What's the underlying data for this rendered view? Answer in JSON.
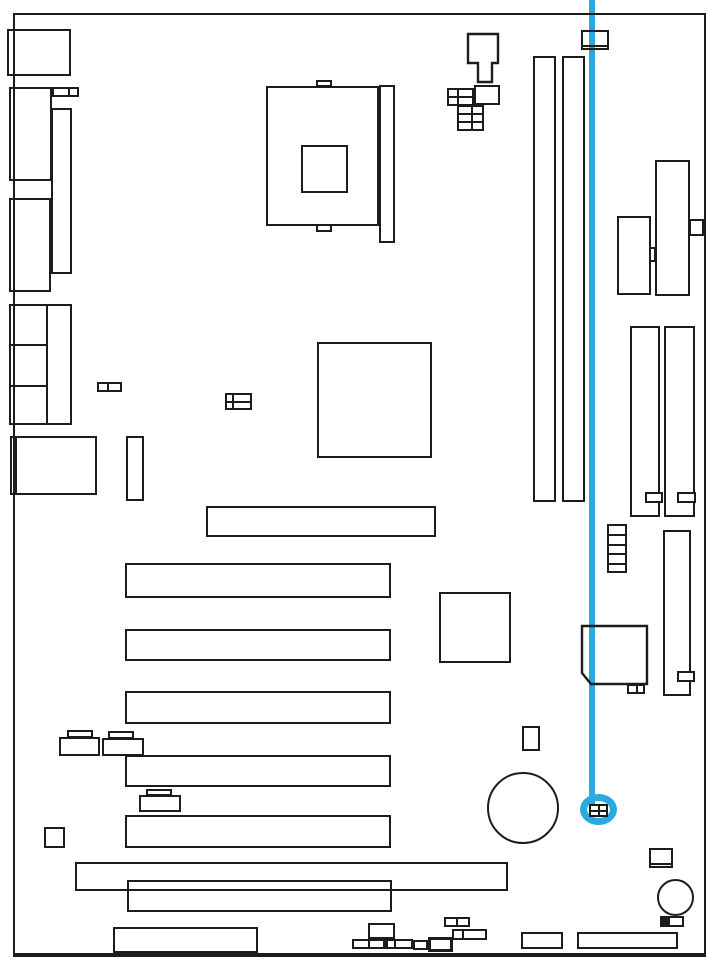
{
  "diagram": {
    "type": "motherboard-layout-callout",
    "description": "Black-and-white motherboard component layout diagram with a blue callout line pointing to a highlighted 2x2 jumper connector near the bottom-right of the board",
    "canvas": {
      "width": 719,
      "height": 972,
      "background": "#ffffff"
    },
    "line_color": "#1c1c1c",
    "highlight_color": "#29abe2",
    "board": {
      "name": "board-outline",
      "x": 13,
      "y": 13,
      "w": 693,
      "h": 944,
      "bw": 2,
      "bw_bottom": 4
    },
    "highlight": {
      "line": {
        "name": "callout-line",
        "x": 589,
        "y": 0,
        "w": 6,
        "h": 804
      },
      "ring": {
        "name": "callout-ring",
        "x": 580,
        "y": 794,
        "w": 37,
        "h": 31,
        "bw": 7
      },
      "target": {
        "name": "highlighted-jumper",
        "x": 589,
        "y": 804,
        "w": 19,
        "h": 13,
        "bg": "#ffffff",
        "lines": [
          {
            "x": 9,
            "y": 0,
            "w": 2,
            "h": 13
          },
          {
            "x": 0,
            "y": 6,
            "w": 19,
            "h": 2
          }
        ]
      }
    },
    "components": [
      {
        "name": "io-port-top",
        "x": 7,
        "y": 29,
        "w": 64,
        "h": 47
      },
      {
        "name": "io-port-2",
        "x": 9,
        "y": 87,
        "w": 43,
        "h": 94
      },
      {
        "name": "io-conn-2cell",
        "x": 52,
        "y": 87,
        "w": 27,
        "h": 10,
        "lines": [
          {
            "x": 16,
            "y": 0,
            "w": 2,
            "h": 10
          }
        ]
      },
      {
        "name": "io-stack-bar",
        "x": 51,
        "y": 108,
        "w": 21,
        "h": 166
      },
      {
        "name": "io-port-3",
        "x": 9,
        "y": 198,
        "w": 42,
        "h": 94
      },
      {
        "name": "io-port-group",
        "x": 9,
        "y": 304,
        "w": 63,
        "h": 121,
        "lines": [
          {
            "x": 37,
            "y": 0,
            "w": 2,
            "h": 121
          },
          {
            "x": 0,
            "y": 40,
            "w": 37,
            "h": 2
          },
          {
            "x": 0,
            "y": 81,
            "w": 37,
            "h": 2
          }
        ]
      },
      {
        "name": "io-port-4",
        "x": 10,
        "y": 436,
        "w": 87,
        "h": 59,
        "lines": [
          {
            "x": 5,
            "y": 0,
            "w": 2,
            "h": 59
          }
        ]
      },
      {
        "name": "conn-2cell-mid",
        "x": 97,
        "y": 382,
        "w": 25,
        "h": 10,
        "lines": [
          {
            "x": 10,
            "y": 0,
            "w": 2,
            "h": 10
          }
        ]
      },
      {
        "name": "cpu-tab-top",
        "x": 316,
        "y": 80,
        "w": 16,
        "h": 7
      },
      {
        "name": "cpu-socket",
        "x": 266,
        "y": 86,
        "w": 113,
        "h": 140
      },
      {
        "name": "cpu-die",
        "x": 301,
        "y": 145,
        "w": 47,
        "h": 48
      },
      {
        "name": "cpu-tab-bottom",
        "x": 316,
        "y": 224,
        "w": 16,
        "h": 8
      },
      {
        "name": "cpu-retention-bar",
        "x": 379,
        "y": 85,
        "w": 16,
        "h": 158
      },
      {
        "name": "power-plug",
        "shape": "polygon",
        "points": [
          [
            468,
            34
          ],
          [
            498,
            34
          ],
          [
            498,
            63
          ],
          [
            492,
            63
          ],
          [
            492,
            82
          ],
          [
            478,
            82
          ],
          [
            478,
            63
          ],
          [
            468,
            63
          ]
        ]
      },
      {
        "name": "conn-grid-2x2",
        "x": 447,
        "y": 88,
        "w": 27,
        "h": 18,
        "lines": [
          {
            "x": 10,
            "y": 0,
            "w": 2,
            "h": 18
          },
          {
            "x": 0,
            "y": 8,
            "w": 27,
            "h": 2
          }
        ]
      },
      {
        "name": "conn-rect-top",
        "x": 474,
        "y": 85,
        "w": 26,
        "h": 20
      },
      {
        "name": "conn-grid-2x3",
        "x": 457,
        "y": 105,
        "w": 27,
        "h": 26,
        "lines": [
          {
            "x": 14,
            "y": 0,
            "w": 2,
            "h": 26
          },
          {
            "x": 0,
            "y": 8,
            "w": 27,
            "h": 2
          },
          {
            "x": 0,
            "y": 16,
            "w": 27,
            "h": 2
          }
        ]
      },
      {
        "name": "conn-top-right",
        "x": 581,
        "y": 30,
        "w": 28,
        "h": 20,
        "lines": [
          {
            "x": 0,
            "y": 15,
            "w": 28,
            "h": 2
          }
        ]
      },
      {
        "name": "dimm-slot-1",
        "x": 533,
        "y": 56,
        "w": 23,
        "h": 446
      },
      {
        "name": "dimm-slot-2",
        "x": 562,
        "y": 56,
        "w": 23,
        "h": 446
      },
      {
        "name": "chip-ne",
        "x": 655,
        "y": 160,
        "w": 35,
        "h": 136
      },
      {
        "name": "chip-ne-tab",
        "x": 689,
        "y": 219,
        "w": 15,
        "h": 17
      },
      {
        "name": "chip-ne-notch",
        "x": 649,
        "y": 247,
        "w": 7,
        "h": 15
      },
      {
        "name": "rect-ne",
        "x": 617,
        "y": 216,
        "w": 34,
        "h": 79
      },
      {
        "name": "right-slot-1",
        "x": 630,
        "y": 326,
        "w": 30,
        "h": 191
      },
      {
        "name": "right-slot-2",
        "x": 664,
        "y": 326,
        "w": 31,
        "h": 191
      },
      {
        "name": "right-slot-1-key",
        "x": 645,
        "y": 492,
        "w": 18,
        "h": 11,
        "bg": "#ffffff"
      },
      {
        "name": "right-slot-2-key",
        "x": 677,
        "y": 492,
        "w": 19,
        "h": 11,
        "bg": "#ffffff"
      },
      {
        "name": "ladder-conn",
        "x": 607,
        "y": 524,
        "w": 20,
        "h": 49,
        "lines": [
          {
            "x": 0,
            "y": 10,
            "w": 20,
            "h": 2
          },
          {
            "x": 0,
            "y": 20,
            "w": 20,
            "h": 2
          },
          {
            "x": 0,
            "y": 29,
            "w": 20,
            "h": 2
          },
          {
            "x": 0,
            "y": 39,
            "w": 20,
            "h": 2
          }
        ]
      },
      {
        "name": "tall-slot-se",
        "x": 663,
        "y": 530,
        "w": 28,
        "h": 166
      },
      {
        "name": "tall-slot-se-tab",
        "x": 677,
        "y": 671,
        "w": 18,
        "h": 11,
        "bg": "#ffffff"
      },
      {
        "name": "northbridge-chip",
        "x": 317,
        "y": 342,
        "w": 115,
        "h": 116
      },
      {
        "name": "conn-grid-4cell",
        "x": 225,
        "y": 393,
        "w": 27,
        "h": 17,
        "lines": [
          {
            "x": 7,
            "y": 0,
            "w": 2,
            "h": 17
          },
          {
            "x": 0,
            "y": 8,
            "w": 27,
            "h": 2
          }
        ]
      },
      {
        "name": "vert-conn-mid",
        "x": 126,
        "y": 436,
        "w": 18,
        "h": 65
      },
      {
        "name": "chip-center-2",
        "x": 439,
        "y": 592,
        "w": 72,
        "h": 71
      },
      {
        "name": "southbridge-chip",
        "shape": "polygon",
        "points": [
          [
            582,
            626
          ],
          [
            647,
            626
          ],
          [
            647,
            684
          ],
          [
            591,
            684
          ],
          [
            582,
            673
          ]
        ]
      },
      {
        "name": "southbridge-conn",
        "x": 627,
        "y": 684,
        "w": 18,
        "h": 10,
        "lines": [
          {
            "x": 9,
            "y": 0,
            "w": 2,
            "h": 10
          }
        ]
      },
      {
        "name": "slot-agp",
        "x": 206,
        "y": 506,
        "w": 230,
        "h": 31
      },
      {
        "name": "pci-slot-1",
        "x": 125,
        "y": 563,
        "w": 266,
        "h": 35
      },
      {
        "name": "pci-slot-2",
        "x": 125,
        "y": 629,
        "w": 266,
        "h": 32
      },
      {
        "name": "pci-slot-3",
        "x": 125,
        "y": 691,
        "w": 266,
        "h": 33
      },
      {
        "name": "pci-slot-4",
        "x": 125,
        "y": 755,
        "w": 266,
        "h": 32
      },
      {
        "name": "pci-slot-5",
        "x": 125,
        "y": 815,
        "w": 266,
        "h": 33
      },
      {
        "name": "slot-long-bottom",
        "x": 75,
        "y": 862,
        "w": 433,
        "h": 29
      },
      {
        "name": "slot-bottom-2",
        "x": 127,
        "y": 880,
        "w": 265,
        "h": 32
      },
      {
        "name": "jumper-a-tab",
        "x": 67,
        "y": 730,
        "w": 26,
        "h": 8
      },
      {
        "name": "jumper-a-body",
        "x": 59,
        "y": 737,
        "w": 41,
        "h": 19,
        "bg": "#ffffff"
      },
      {
        "name": "jumper-b-tab",
        "x": 108,
        "y": 731,
        "w": 26,
        "h": 8
      },
      {
        "name": "jumper-b-body",
        "x": 102,
        "y": 738,
        "w": 42,
        "h": 18,
        "bg": "#ffffff"
      },
      {
        "name": "jumper-c-tab",
        "x": 146,
        "y": 789,
        "w": 26,
        "h": 7
      },
      {
        "name": "jumper-c-body",
        "x": 139,
        "y": 795,
        "w": 42,
        "h": 17,
        "bg": "#ffffff"
      },
      {
        "name": "square-small-sw",
        "x": 44,
        "y": 827,
        "w": 21,
        "h": 21
      },
      {
        "name": "battery",
        "x": 487,
        "y": 772,
        "w": 72,
        "h": 72,
        "shape": "circle"
      },
      {
        "name": "vert-conn-low",
        "x": 522,
        "y": 726,
        "w": 18,
        "h": 25
      },
      {
        "name": "conn-se-boxed",
        "x": 649,
        "y": 848,
        "w": 24,
        "h": 20,
        "lines": [
          {
            "x": 0,
            "y": 15,
            "w": 24,
            "h": 2
          }
        ]
      },
      {
        "name": "buzzer",
        "x": 657,
        "y": 879,
        "w": 37,
        "h": 37,
        "shape": "circle"
      },
      {
        "name": "conn-se-2cell",
        "x": 660,
        "y": 916,
        "w": 24,
        "h": 11,
        "lines": [
          {
            "x": 8,
            "y": 0,
            "w": 2,
            "h": 11
          }
        ],
        "fills": [
          {
            "x": 0,
            "y": 0,
            "w": 8,
            "h": 11,
            "color": "#1c1c1c"
          }
        ]
      },
      {
        "name": "front-panel-header",
        "x": 113,
        "y": 927,
        "w": 145,
        "h": 26
      },
      {
        "name": "cluster-square",
        "x": 368,
        "y": 923,
        "w": 27,
        "h": 16
      },
      {
        "name": "cluster-row",
        "x": 352,
        "y": 939,
        "w": 61,
        "h": 10,
        "lines": [
          {
            "x": 16,
            "y": 0,
            "w": 2,
            "h": 10
          },
          {
            "x": 42,
            "y": 0,
            "w": 2,
            "h": 10
          }
        ],
        "fills": [
          {
            "x": 31,
            "y": 0,
            "w": 5,
            "h": 10,
            "color": "#1c1c1c"
          }
        ]
      },
      {
        "name": "cluster-cell",
        "x": 413,
        "y": 940,
        "w": 15,
        "h": 10
      },
      {
        "name": "cluster-thick",
        "x": 428,
        "y": 937,
        "w": 25,
        "h": 15,
        "bw": 3
      },
      {
        "name": "cluster-2cell-a",
        "x": 444,
        "y": 917,
        "w": 26,
        "h": 10,
        "lines": [
          {
            "x": 12,
            "y": 0,
            "w": 2,
            "h": 10
          }
        ]
      },
      {
        "name": "cluster-2cell-b",
        "x": 452,
        "y": 929,
        "w": 35,
        "h": 11,
        "lines": [
          {
            "x": 10,
            "y": 0,
            "w": 2,
            "h": 11
          }
        ]
      },
      {
        "name": "conn-bottom-mid",
        "x": 521,
        "y": 932,
        "w": 42,
        "h": 17
      },
      {
        "name": "conn-bottom-right",
        "x": 577,
        "y": 932,
        "w": 101,
        "h": 17
      }
    ]
  }
}
